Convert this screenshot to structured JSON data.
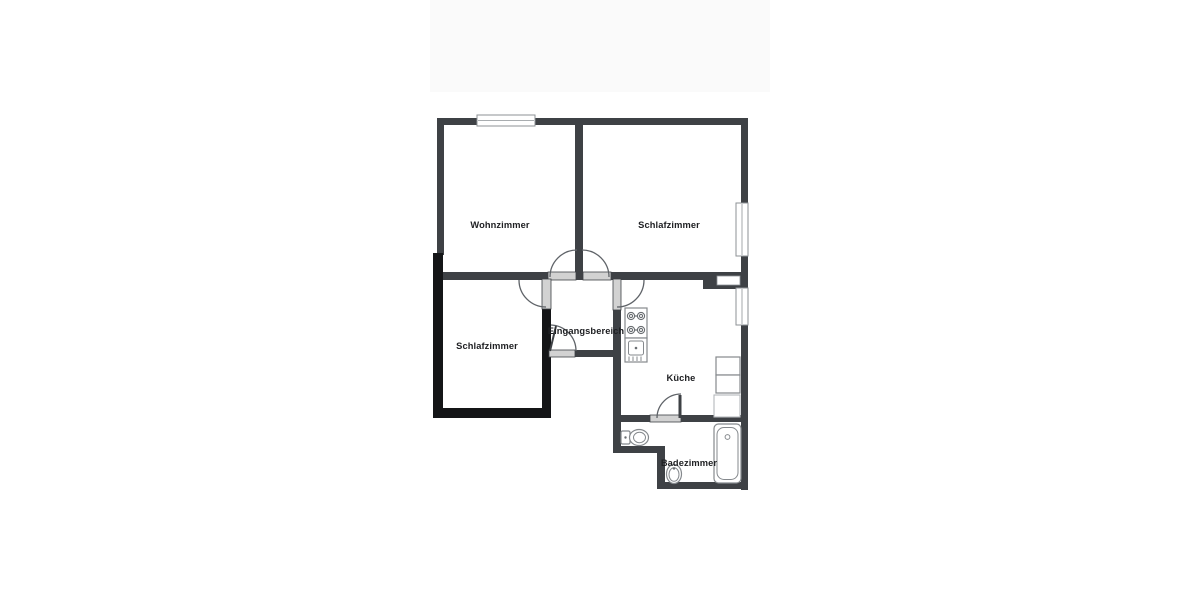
{
  "floorplan": {
    "rooms": [
      {
        "id": "wohnzimmer",
        "label": "Wohnzimmer"
      },
      {
        "id": "schlafzimmer-top",
        "label": "Schlafzimmer"
      },
      {
        "id": "schlafzimmer-lower",
        "label": "Schlafzimmer"
      },
      {
        "id": "eingangsbereich",
        "label": "Eingangsbereich"
      },
      {
        "id": "kueche",
        "label": "Küche"
      },
      {
        "id": "badezimmer",
        "label": "Badezimmer"
      }
    ],
    "fixtures": [
      "stove-icon",
      "kitchen-sink-icon",
      "kitchen-counter",
      "toilet-icon",
      "washbasin-icon",
      "bathtub-icon"
    ],
    "windows_count": 3,
    "doors_count": 6,
    "colors": {
      "wall": "#3e4145",
      "wall_exterior": "#141517",
      "door_slab": "#d2d2d2",
      "window_frame": "#8d9296",
      "door_arc": "#5f6368",
      "fixture": "#85898d",
      "label": "#202124",
      "top_band": "#fafafa",
      "background": "#ffffff"
    }
  }
}
